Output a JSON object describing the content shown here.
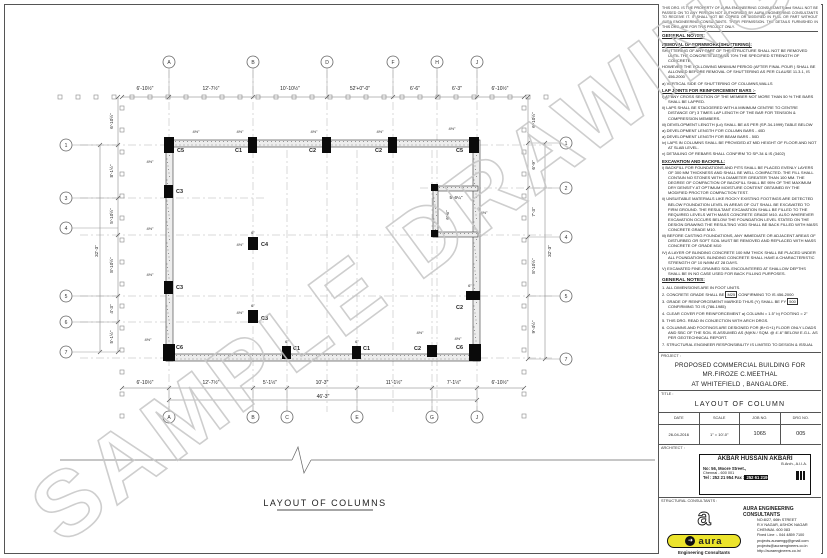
{
  "watermark": "SAMPLE DRAWINGS",
  "disclaimer": "THIS DRG. IS THE PROPERTY OF AURA ENGINEERING CONSULTANTS and SHALL NOT BE PASSED ON TO ANY PERSON NOT AUTHORISED BY AURA ENGINEERING CONSULTANTS TO RECEIVE IT. IT SHALL NOT BE COPIED OR MODIFIED IN FULL OR PART WITHOUT AURA ENGINEERING CONSULTANTS. THEIR PERMISSION. THE DETAILS FURNISHED IN THIS DRG. ARE FOR THIS PROJECT ONLY.",
  "notes": {
    "heading": "GENERAL NOTES:",
    "sections": [
      {
        "title": "REMOVAL OF FORMWORK(SHUTTERING):",
        "items": [
          "SHUTTERING OF ANY PART OF THE STRUCTURE SHALL NOT BE REMOVED UNTIL THE CONCRETE ATTAINS 70% THE SPECIFIED STRENGTH OF CONCRETE.",
          "HOWEVER THE FOLLOWING MINIMUM PERIOD (AFTER FINAL POUR ) SHALL BE ALLOWED BEFORE REMOVAL OF SHUTTERING AS PER CLAUSE 11.3.1, IS 456-2000",
          "a) VERTICAL SIDE OF SHUTTERING OF COLUMNS,WALLS"
        ]
      },
      {
        "title": "LAP JOINTS FOR REINFORCEMENT BARS :-",
        "items": [
          "i) AT ANY CROSS SECTION OF THE MEMBER NOT MORE THAN 50 % THE BARS SHALL BE LAPPED.",
          "ii) LAPS SHALL BE STAGGERED WITH A MINIMUM CENTRE TO CENTRE DISTANCE OF) 3 TIMES LAP LENGTH OF THE BAR FOR TENSION & COMPRESSION MEMBERS.",
          "iii) DEVELOPMENT LENGTH (Ld) SHALL BE AS PER (SP-34-1999) TABLE BELOW",
          "a) DEVELOPMENT LENGTH FOR COLUMN BARS - 40D",
          "a) DEVELOPMENT LENGTH FOR BEAM BARS - 50D",
          "iv) LAPS IN COLUMNS SHALL BE PROVIDED AT MID HEIGHT OF FLOOR AND NOT AT SLAB LEVEL.",
          "v) DETAILING OF REBARS SHALL CONFIRM TO SP-34 & IS (3402)"
        ]
      },
      {
        "title": "EXCAVATION AND BACKFILL:",
        "items": [
          "i) BACKFILL FOR FOUNDATIONS AND PITS SHALL BE PLACED EVENLY LAYERS OF 300 MM THICKNESS AND SHALL BE WELL COMPACTED. THE FILL SHALL CONTAIN NO STONES WITH A DIAMETER GREATER THAN 100 MM. THE DEGREE OF COMPACTION OF BACKFILL SHALL BE 95% OF THE MAXIMUM DRY DENSITY AT OPTIMUM MOISTURE CONTENT OBTAINED BY THE MODIFIED PROCTOR COMPACTION TEST.",
          "ii) UNSUITABLE MATERIALS LIKE ROCKY EXISTING FOOTINGS ARE DETECTED BELOW FOUNDATION LEVEL IN AREAS OF CUT SHALL BE EXCAVATED TO FIRM GROUND. THE RESULTANT EXCAVATION SHALL BE FILLED TO THE REQUIRED LEVELS WITH MASS CONCRETE GRADE M10. ALSO WHEREVER EXCAVATION OCCURS BELOW THE FOUNDATION LEVEL STATED ON THE DESIGN DRAWING THE RESULTING VOID SHALL BE BACK FILLED WITH MASS CONCRETE GRADE M10.",
          "iii) BEFORE CASTING FOUNDATIONS, ANY IMMEDIATE OR ADJACENT AREAS OF DISTURBED OR SOFT SOIL MUST BE REMOVED AND REPLACED WITH MASS CONCRETE OF GRADE M10",
          "IV) A LAYER OF BLINDING CONCRETE 100 MM THICK SHALL BE PLACED UNDER ALL FOUNDATIONS. BLINDING CONCRETE SHALL HAVE A CHARACTERISTIC STRENGTH OF 10 N/MM AT 28 DAYS.",
          "V) EXCAVATED FINE-GRAINED SOIL ENCOUNTERED AT SHALLOW DEPTHS SHALL BE IN NO CASE USED FOR BACK FILLING PURPOSES."
        ]
      }
    ]
  },
  "general_notes": {
    "heading": "GENERAL NOTES:",
    "items": {
      "n1": "1. ALL DIMENSIONS ARE IN FOOT UNITS.",
      "n2_pre": "2. CONCRETE GRADE SHALL BE",
      "n2_box": "M25",
      "n2_post": "CONFIRMING TO IS 456-2000",
      "n3_pre": "3. GRADE OF REINFORCEMENT MARKED THUS (Y) SHALL BE FY",
      "n3_box": "500",
      "n3_post": "CONFIRMING TO IS (786-1985)",
      "n4": "4. CLEAR COVER FOR REINFORCEMENT   a) COLUMN = 1.5\"   b) FOOTING = 2\"",
      "n5": "5. THIS DRG. READ IN CONJECTION WITH ARCH DRGS.",
      "n6": "6. COLUMNS AND FOOTINGS ARE DESIGNED FOR (B+G+1) FLOOR ONLY LOADS AND SBC OF THE SOIL IS ASSUMED AS (N)KN / SQM. @ 4'-6\" BELOW E.G.L. AS PER GEOTECHNICAL REPORT.",
      "n7": "7. STRUCTURAL ENGINEER RESPONSIBILITY IS LIMITED TO DESIGN & ISSUAL OF STRUCTURAL DRAWING ONLY",
      "n8": "8. ONUS OF CONSTRUCTION LIES WITH CONTRACTOR/OWNER"
    }
  },
  "project": {
    "label": "PROJECT :",
    "lines": [
      "PROPOSED COMMERCIAL BUILDING FOR",
      "MR.FIROZE C.MEETHAL",
      "AT WHITEFIELD , BANGALORE."
    ]
  },
  "title_block": {
    "label": "TITLE :",
    "title": "LAYOUT OF COLUMN"
  },
  "info_table": {
    "headers": [
      "DATE",
      "SCALE",
      "JOB NO.",
      "DRG NO."
    ],
    "values": [
      "26-04-2016",
      "1\" = 10'-0\"",
      "1065",
      "005"
    ]
  },
  "architect": {
    "label": "ARCHITECT :",
    "name": "AKBAR HUSSAIN AKBARI",
    "qualification": "B.Arch., A.I.I.A.",
    "address1": "No: 56, Moore Street.,",
    "address2": "Chennai - 600 001",
    "tel_a": "Tel : 252 21 954 Fax :",
    "tel_b": " 252 61 219"
  },
  "firm": {
    "label": "STRUCTURAL CONSULTANTS :",
    "logo_letter": "a",
    "logo_arrow": "➜",
    "logo_word": "aura",
    "tagline": "Engineering Consultants",
    "name": "AURA ENGINEERING CONSULTANTS",
    "lines": [
      "NO:8/27, 66th STREET",
      "R.V NAGAR, ASHOK NAGAR",
      "CHENNAI- 600 083",
      "Fixed Line :- 044 4859 7100",
      "projects.auraengg@gmail.com",
      "projects@auraengineers.co.in",
      "http://auraengineers.co.in/"
    ]
  },
  "plan": {
    "title": "LAYOUT OF COLUMNS",
    "labels": {
      "C1": "C1",
      "C2": "C2",
      "C3": "C3",
      "C4": "C4",
      "C5": "C5",
      "C6": "C6"
    },
    "tick": "4½\"",
    "tick6": "6\"",
    "shaft_w": "5'-6¼\"",
    "shaft_h": "6'-6\"",
    "top_grid": [
      "A",
      "B",
      "D",
      "F",
      "H",
      "J"
    ],
    "bottom_grid": [
      "A",
      "B",
      "C",
      "E",
      "G",
      "J"
    ],
    "left_rows": [
      "1",
      "3",
      "4",
      "5",
      "6",
      "7"
    ],
    "right_rows": [
      "1",
      "2",
      "4",
      "5",
      "7"
    ],
    "top_dims": [
      "6'-10½\"",
      "12'-7½\"",
      "10'-10½\"",
      "52'+0\"-0\"",
      "6'-6\"",
      "6'-3\"",
      "6'-10½\""
    ],
    "bottom_dims": [
      "6'-10½\"",
      "12'-7½\"",
      "5'-1½\"",
      "10'-3\"",
      "11'-1½\"",
      "7'-1½\"",
      "6'-10½\""
    ],
    "bottom_total": "46'-3\"",
    "left_dims": [
      "6'-10½\"",
      "8'-1½\"",
      "5'-10½\"",
      "8'-10½\"",
      "4'-3\"",
      "5'-1½\""
    ],
    "left_total": "32'-3\"",
    "right_dims": [
      "6'-10½\"",
      "6'-9\"",
      "7'-3\"",
      "8'-10½\"",
      "9'-4½\""
    ],
    "right_total": "32'-3\""
  },
  "colors": {
    "aura_yellow": "#ece42c",
    "watermark_gray": "#c6c6c6",
    "line_gray": "#555555"
  }
}
